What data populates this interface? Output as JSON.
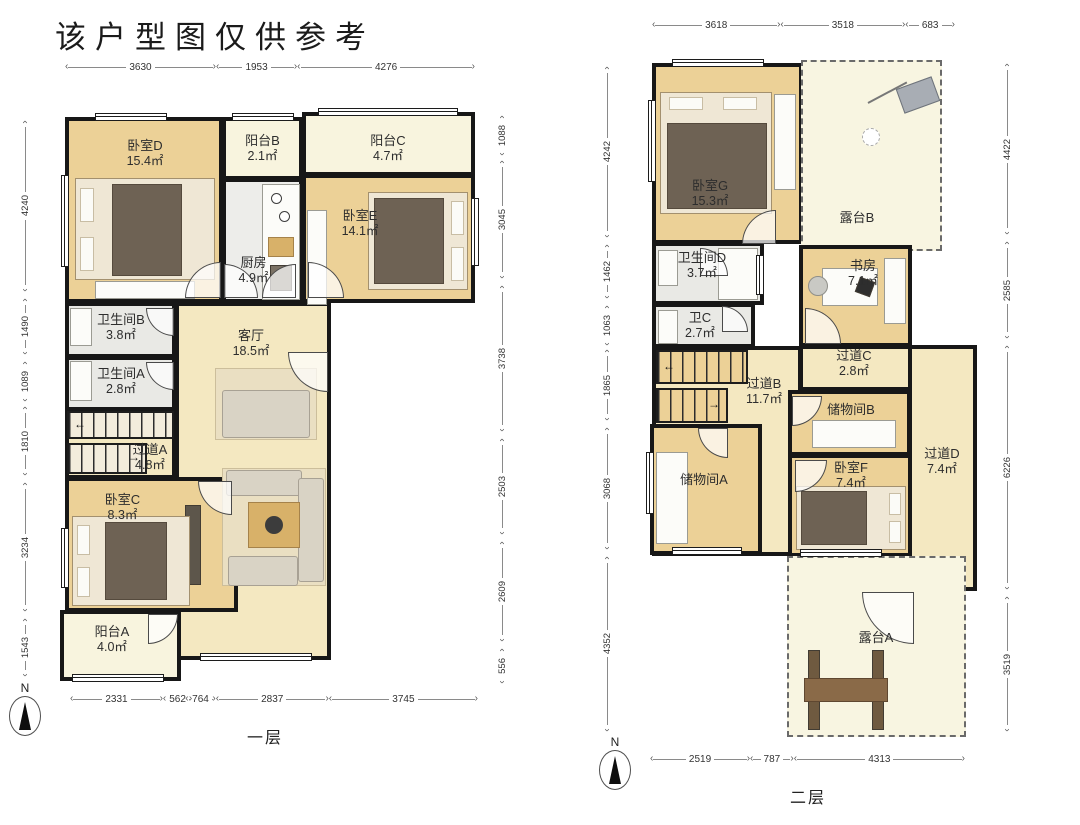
{
  "title": "该户型图仅供参考",
  "compass": {
    "n": "N"
  },
  "floor1": {
    "label": "一层",
    "stair_up_arrow": "←",
    "stair_down_arrow": "→",
    "dims": {
      "top": [
        "3630",
        "1953",
        "4276"
      ],
      "left": [
        "4240",
        "1490",
        "1089",
        "1810",
        "3234",
        "1543"
      ],
      "right": [
        "1088",
        "3045",
        "3738",
        "2503",
        "2609",
        "556"
      ],
      "bottom": [
        "2331",
        "562",
        "764",
        "2837",
        "3745"
      ]
    },
    "rooms": {
      "bedroomD": {
        "name": "卧室D",
        "area": "15.4㎡"
      },
      "balconyB": {
        "name": "阳台B",
        "area": "2.1㎡"
      },
      "balconyC": {
        "name": "阳台C",
        "area": "4.7㎡"
      },
      "bedroomE": {
        "name": "卧室E",
        "area": "14.1㎡"
      },
      "kitchen": {
        "name": "厨房",
        "area": "4.9㎡"
      },
      "livingRoom": {
        "name": "客厅",
        "area": "18.5㎡"
      },
      "bathB": {
        "name": "卫生间B",
        "area": "3.8㎡"
      },
      "bathA": {
        "name": "卫生间A",
        "area": "2.8㎡"
      },
      "hallA": {
        "name": "过道A",
        "area": "4.8㎡"
      },
      "bedroomC": {
        "name": "卧室C",
        "area": "8.3㎡"
      },
      "balconyA": {
        "name": "阳台A",
        "area": "4.0㎡"
      }
    }
  },
  "floor2": {
    "label": "二层",
    "stair_up_arrow": "←",
    "stair_down_arrow": "→",
    "dims": {
      "top": [
        "3618",
        "3518",
        "683"
      ],
      "left": [
        "4242",
        "1462",
        "1063",
        "1865",
        "3068",
        "4352"
      ],
      "right": [
        "4422",
        "2585",
        "6226",
        "3519"
      ],
      "bottom": [
        "2519",
        "787",
        "4313"
      ]
    },
    "rooms": {
      "bedroomG": {
        "name": "卧室G",
        "area": "15.3㎡"
      },
      "terraceB": {
        "name": "露台B",
        "area": ""
      },
      "bathD": {
        "name": "卫生间D",
        "area": "3.7㎡"
      },
      "study": {
        "name": "书房",
        "area": "7.1㎡"
      },
      "bathC": {
        "name": "卫C",
        "area": "2.7㎡"
      },
      "hallC": {
        "name": "过道C",
        "area": "2.8㎡"
      },
      "hallB": {
        "name": "过道B",
        "area": "11.7㎡"
      },
      "storageB": {
        "name": "储物间B",
        "area": ""
      },
      "storageA": {
        "name": "储物间A",
        "area": ""
      },
      "bedroomF": {
        "name": "卧室F",
        "area": "7.4㎡"
      },
      "hallD": {
        "name": "过道D",
        "area": "7.4㎡"
      },
      "terraceA": {
        "name": "露台A",
        "area": ""
      }
    }
  }
}
